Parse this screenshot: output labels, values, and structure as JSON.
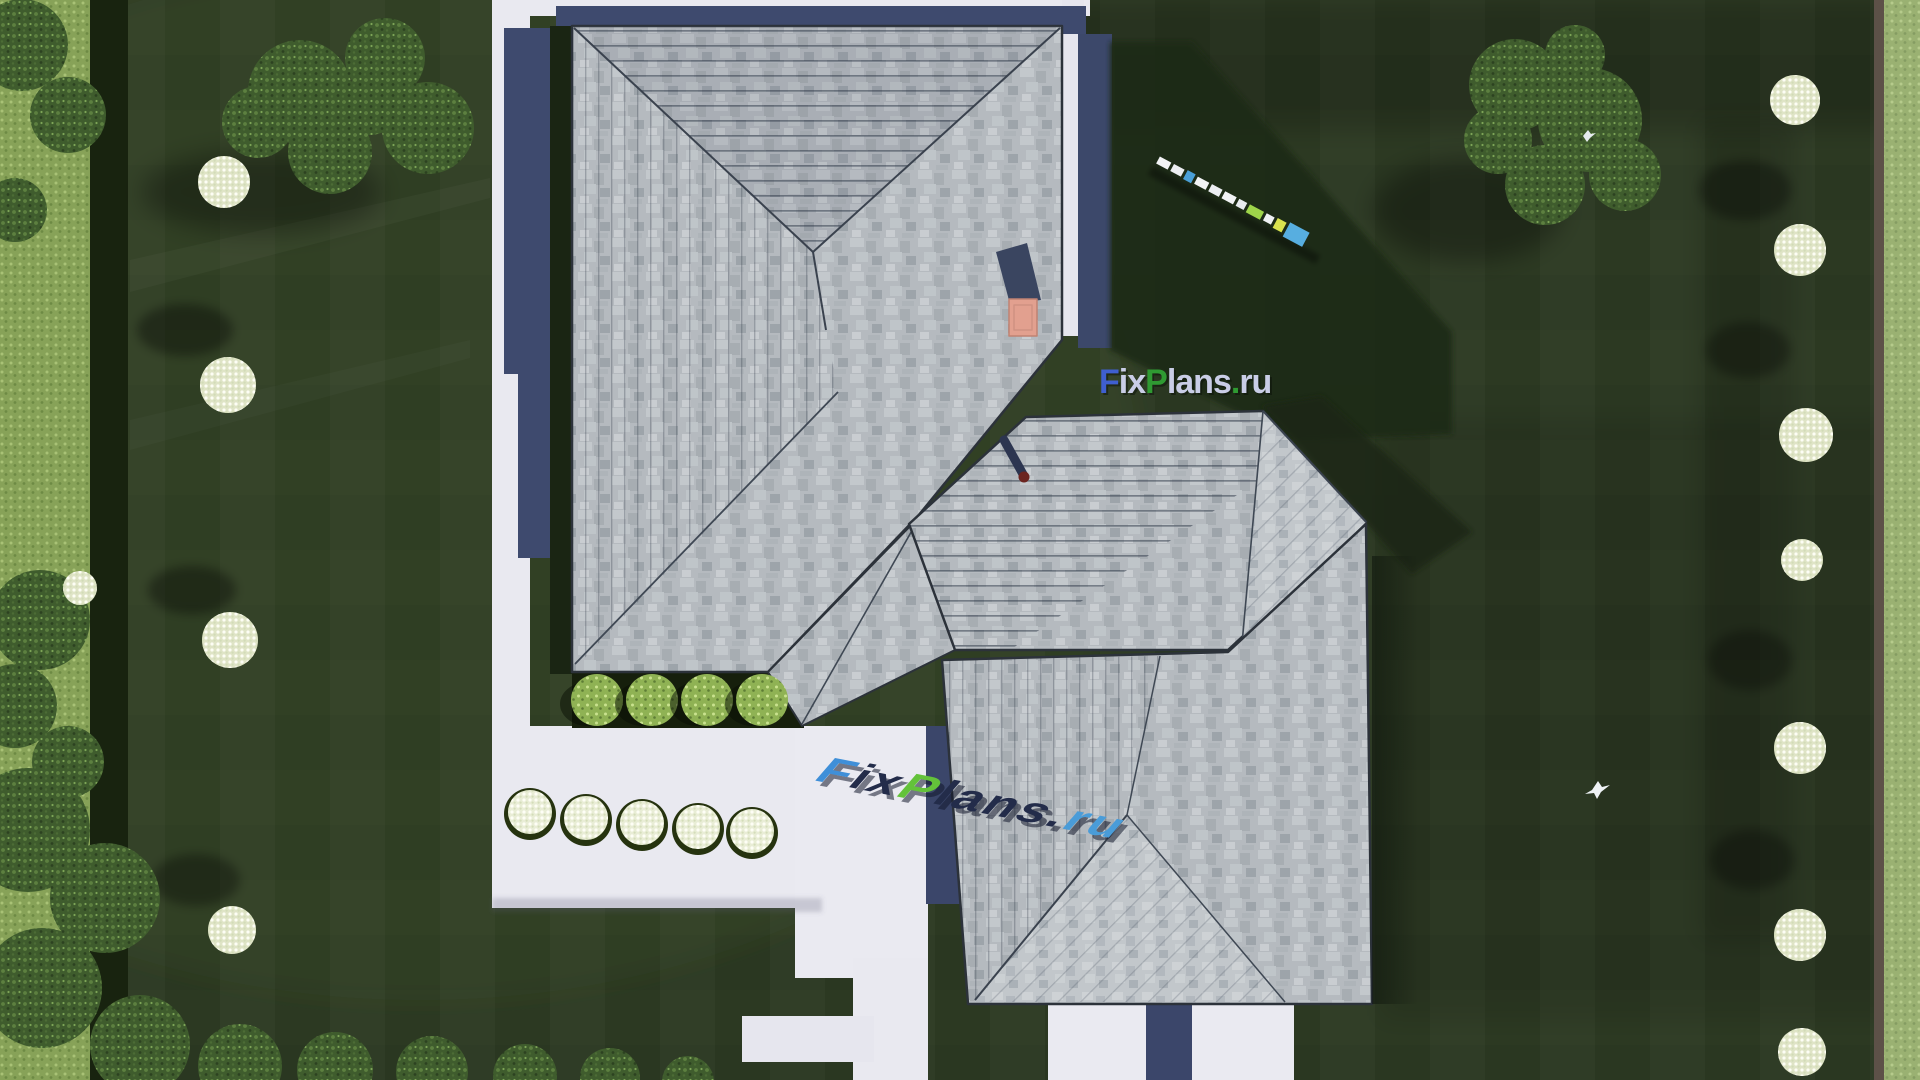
{
  "watermark_overlay": {
    "text": "FixPlans.ru",
    "parts": [
      {
        "t": "F",
        "color": "#3f5fd0"
      },
      {
        "t": "ix",
        "color": "#c9cde6"
      },
      {
        "t": "P",
        "color": "#2f9a32"
      },
      {
        "t": "lans",
        "color": "#c9cde6"
      },
      {
        "t": ".",
        "color": "#2f9a32"
      },
      {
        "t": "ru",
        "color": "#c9cde6"
      }
    ]
  },
  "watermark_ground": {
    "text": "FixPlans.ru",
    "parts": [
      {
        "t": "F",
        "color": "#3f8fd8"
      },
      {
        "t": "ix",
        "color": "#232c4a"
      },
      {
        "t": "P",
        "color": "#63c23a"
      },
      {
        "t": "lans",
        "color": "#232c4a"
      },
      {
        "t": ".",
        "color": "#232c4a"
      },
      {
        "t": "ru",
        "color": "#4a9cd8"
      }
    ]
  },
  "garden_bench": {
    "segment_colors": [
      "#f2f3f5",
      "#eceef2",
      "#4a9fd8",
      "#f2f3f5",
      "#eceef2",
      "#f2f3f5",
      "#e8ebef",
      "#9ed54a",
      "#eff1f3",
      "#d9e24e",
      "#57aee0"
    ]
  },
  "palette": {
    "lawn": "#2c3922",
    "lawn_shadow": "#1f2a16",
    "lawn_outside": "#87a258",
    "foliage": "#3f5c2d",
    "paving": "#e9e9f0",
    "shadow_navy": "#3e4a6e",
    "roof_shingle": "#b5babf",
    "roof_light": "#c2c7cb",
    "ridge_line": "#3a424e",
    "chimney": "#e2a08f",
    "vent": "#6b2420",
    "planter_soil": "#161f0c",
    "bush_green": "#8fb254",
    "bloom_white": "#dfe4c6",
    "hedge_dark": "#18230f",
    "fence_right": "#5d5148",
    "bird_white": "#eef2f5"
  }
}
